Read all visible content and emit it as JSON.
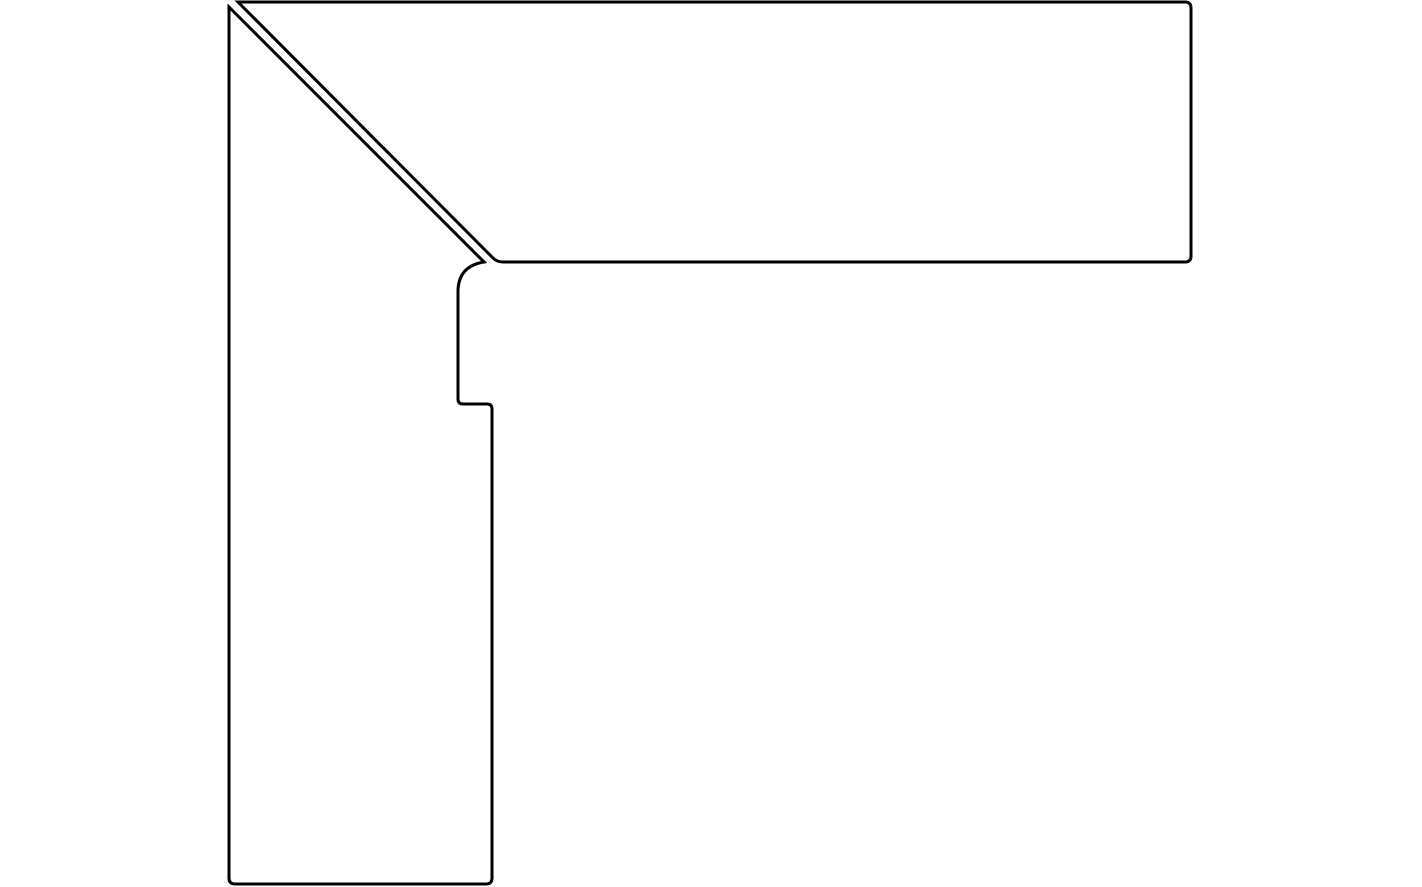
{
  "canvas": {
    "width": 1422,
    "height": 887,
    "background_color": "#ffffff"
  },
  "drawing": {
    "description": "Black outline profile drawing of a two-piece external mitered corner: a horizontal skirting profile and a vertical skirting profile joined along a 45-degree miter line with a thin gap between the two mitered edges; the vertical piece has a stepped (rebated) right edge and a small hooked curve under the miter tip.",
    "stroke_color": "#000000",
    "stroke_width": 3,
    "fill_color": "#ffffff",
    "shapes": [
      {
        "name": "horizontal-piece",
        "role": "top horizontal profile with 45-degree mitered left end",
        "path": "M 238 2 L 1185 2 Q 1191 2 1191 8 L 1191 256 Q 1191 262 1185 262 L 503 262 Q 497 262 493 258 L 238 2 Z"
      },
      {
        "name": "vertical-piece",
        "role": "left vertical profile with 45-degree mitered top end, hooked curve, stepped right edge",
        "path": "M 229 7 L 484 262 Q 459 266 458 290 L 458 399 Q 458 404 463 404 L 487 404 Q 492 404 492 409 L 492 878 Q 492 884 486 884 L 235 884 Q 229 884 229 878 Z"
      }
    ]
  }
}
